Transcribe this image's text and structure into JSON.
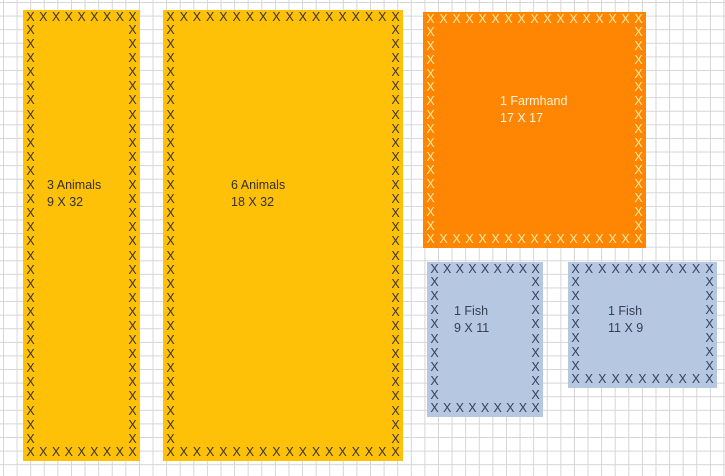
{
  "x_mark_char": "X",
  "canvas": {
    "background": "#ffffff",
    "grid_line_color": "#d5d5d5",
    "cell_size_px": 13.6
  },
  "regions": [
    {
      "id": "3-animals",
      "line1": "3 Animals",
      "line2": "9 X 32",
      "fill": "#FFC107",
      "mark_color": "#3A3528",
      "text_color": "#33312B",
      "left": 23,
      "top": 10,
      "width": 117,
      "height": 451,
      "marks_across": 9,
      "marks_down": 32,
      "label_left": 24,
      "label_top": 167
    },
    {
      "id": "6-animals",
      "line1": "6 Animals",
      "line2": "18 X 32",
      "fill": "#FFC107",
      "mark_color": "#3A3528",
      "text_color": "#33312B",
      "left": 163,
      "top": 10,
      "width": 240,
      "height": 451,
      "marks_across": 18,
      "marks_down": 32,
      "label_left": 68,
      "label_top": 167
    },
    {
      "id": "1-farmhand",
      "line1": "1 Farmhand",
      "line2": "17 X 17",
      "fill": "#FF8603",
      "mark_color": "#FFE9A0",
      "text_color": "#FFF3D9",
      "left": 423,
      "top": 12,
      "width": 223,
      "height": 236,
      "marks_across": 17,
      "marks_down": 17,
      "label_left": 77,
      "label_top": 81
    },
    {
      "id": "1-fish-9x11",
      "line1": "1 Fish",
      "line2": "9 X 11",
      "fill": "#B5C7E1",
      "mark_color": "#36435A",
      "text_color": "#363F50",
      "left": 427,
      "top": 262,
      "width": 116,
      "height": 155,
      "marks_across": 9,
      "marks_down": 11,
      "label_left": 27,
      "label_top": 41
    },
    {
      "id": "1-fish-11x9",
      "line1": "1 Fish",
      "line2": "11 X 9",
      "fill": "#B5C7E1",
      "mark_color": "#36435A",
      "text_color": "#363F50",
      "left": 568,
      "top": 262,
      "width": 149,
      "height": 126,
      "marks_across": 11,
      "marks_down": 9,
      "label_left": 40,
      "label_top": 41
    }
  ]
}
